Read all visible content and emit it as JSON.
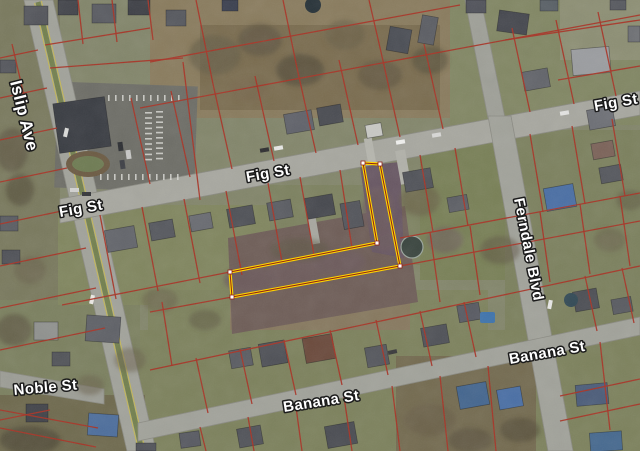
{
  "map": {
    "width": 640,
    "height": 451,
    "base_color": "#83866b",
    "colors": {
      "parcel_line": "#a83325",
      "highlight": "#ffd400",
      "highlight_inner": "#8e2417",
      "vertex": "#ffffff",
      "label_fill": "#ffffff",
      "label_halo": "#1b1b1b",
      "road": "#a5a59d"
    },
    "streets": [
      {
        "id": "islip-ave",
        "name": "Islip Ave",
        "polygon": "24,0 53,0 156,451 127,451",
        "fill": "#a2a39b",
        "median": {
          "line": "38,2 142,451",
          "color": "#73804e",
          "width": 5,
          "edge_color": "#c6b952",
          "edges": [
            "34.6,3 138.6,451",
            "41.4,1 145.4,451"
          ]
        },
        "labels": [
          {
            "text": "Islip Ave",
            "x": 10,
            "y": 82,
            "rotate": 76,
            "size": 17
          }
        ]
      },
      {
        "id": "fig-st",
        "name": "Fig St",
        "polygon": "60,199 640,91 640,115 60,223",
        "fill": "#a8a8a0",
        "labels": [
          {
            "text": "Fig St",
            "x": 60,
            "y": 217,
            "rotate": -10,
            "size": 15
          },
          {
            "text": "Fig St",
            "x": 247,
            "y": 182,
            "rotate": -10,
            "size": 15
          },
          {
            "text": "Fig St",
            "x": 595,
            "y": 111,
            "rotate": -10,
            "size": 15
          }
        ]
      },
      {
        "id": "ferndale-north",
        "name": "",
        "polygon": "465,0 481,0 505,118 488,118",
        "fill": "#9fa098",
        "labels": []
      },
      {
        "id": "ferndale-blvd",
        "name": "Ferndale Blvd",
        "polygon": "488,116 511,116 573,451 548,451",
        "fill": "#a2a39b",
        "labels": [
          {
            "text": "Ferndale Blvd",
            "x": 514,
            "y": 199,
            "rotate": 79,
            "size": 15
          }
        ]
      },
      {
        "id": "banana-st",
        "name": "Banana St",
        "polygon": "138,423 640,317 640,335 138,441",
        "fill": "#a2a39b",
        "labels": [
          {
            "text": "Banana St",
            "x": 284,
            "y": 412,
            "rotate": -9,
            "size": 15
          },
          {
            "text": "Banana St",
            "x": 510,
            "y": 364,
            "rotate": -10,
            "size": 15
          }
        ]
      },
      {
        "id": "noble-st",
        "name": "Noble St",
        "polygon": "0,371 104,389 104,404 0,387",
        "fill": "#9d9e96",
        "labels": [
          {
            "text": "Noble St",
            "x": 14,
            "y": 395,
            "rotate": -5,
            "size": 15
          }
        ]
      }
    ],
    "highlight_parcel": {
      "points": "363,163 380,164 400,266 232,297 230,272 377,243",
      "stroke": "#ffd400",
      "stroke_width": 3.2,
      "under_stroke": "#8e2417",
      "under_width": 1,
      "vertex_fill": "#ffffff",
      "vertex_stroke": "#8e2417",
      "vertex_size": 4,
      "vertices": [
        [
          363,
          163
        ],
        [
          380,
          164
        ],
        [
          400,
          266
        ],
        [
          232,
          297
        ],
        [
          230,
          272
        ],
        [
          377,
          243
        ]
      ]
    },
    "patches": [
      [
        0,
        0,
        60,
        300,
        "#7a7a5e",
        1,
        0
      ],
      [
        0,
        300,
        140,
        151,
        "#7c8160",
        1,
        0
      ],
      [
        150,
        0,
        310,
        118,
        "#8a7c5e",
        1,
        0
      ],
      [
        200,
        25,
        240,
        85,
        "#7b6d50",
        1,
        0
      ],
      [
        450,
        0,
        190,
        125,
        "#828764",
        1,
        0
      ],
      [
        560,
        0,
        80,
        60,
        "#8d8f74",
        1,
        0
      ],
      [
        58,
        205,
        220,
        100,
        "#81865f",
        1,
        0
      ],
      [
        270,
        185,
        150,
        80,
        "#7d8260",
        1,
        0
      ],
      [
        420,
        140,
        220,
        140,
        "#798057",
        1,
        0
      ],
      [
        505,
        130,
        135,
        210,
        "#7c815e",
        1,
        0
      ],
      [
        148,
        290,
        340,
        125,
        "#7e835e",
        1,
        0
      ],
      [
        230,
        296,
        180,
        68,
        "#87795f",
        1,
        0
      ],
      [
        140,
        330,
        500,
        121,
        "#7d825d",
        1,
        0
      ],
      [
        396,
        356,
        140,
        95,
        "#746b50",
        1,
        0
      ],
      [
        0,
        395,
        145,
        56,
        "#6f6a4e",
        1,
        0
      ],
      {
        "points": "228,238 405,206 418,302 232,334",
        "fill": "#6f5e58",
        "opacity": 1
      },
      {
        "points": "360,166 400,162 404,258 372,252",
        "fill": "#685763",
        "opacity": 1
      },
      [
        56,
        84,
        140,
        106,
        "#6e6e67",
        1,
        2
      ]
    ],
    "driveways": [
      [
        398,
        150,
        10,
        34,
        -10,
        "#b2b2aa"
      ],
      [
        366,
        138,
        8,
        26,
        -10,
        "#b6b6ae"
      ],
      [
        310,
        218,
        8,
        26,
        -10,
        "#a8a8a0"
      ]
    ],
    "parcel_lines": {
      "color": "#a83325",
      "width": 1.3,
      "opacity": 0.95,
      "segments": [
        "140,108 640,15",
        "150,62 460,5",
        "50,68 183,58",
        "183,62 200,200",
        "78,0 83,44",
        "112,0 117,42",
        "148,0 153,40",
        "45,45 150,28",
        "150,184 131,98",
        "190,177 171,91",
        "232,169 213,84",
        "274,161 255,76",
        "316,153 297,68",
        "358,145 339,60",
        "400,137 381,52",
        "443,129 424,44",
        "213,84 196,0",
        "297,68 283,0",
        "381,52 369,0",
        "530,112 512,28",
        "574,104 556,20",
        "616,96 598,12",
        "505,40 640,20",
        "558,80 640,66",
        "62,305 230,272",
        "400,238 640,193",
        "150,312 232,297",
        "400,266 640,221",
        "150,370 640,266",
        "100,215 116,299",
        "142,207 158,291",
        "184,199 200,283",
        "226,191 242,275",
        "268,183 282,262",
        "300,177 314,255",
        "340,170 352,248",
        "420,155 433,232",
        "455,148 468,226",
        "530,134 543,212",
        "572,126 585,204",
        "612,119 625,196",
        "196,358 208,413",
        "240,349 252,404",
        "284,340 296,395",
        "330,330 342,385",
        "376,320 388,375",
        "420,311 432,366",
        "464,302 476,357",
        "585,276 597,331",
        "622,268 634,323",
        "430,232 440,302",
        "470,226 480,295",
        "540,212 550,282",
        "580,204 590,274",
        "620,196 630,266",
        "162,302 172,366",
        "200,427 206,451",
        "248,417 254,451",
        "296,407 302,451",
        "344,397 352,451",
        "392,386 400,451",
        "440,376 448,451",
        "488,366 496,451",
        "600,342 610,430",
        "560,396 640,379",
        "560,421 640,404",
        "0,428 96,447",
        "0,58 38,50",
        "0,98 47,88",
        "0,140 57,128",
        "0,182 67,168",
        "0,224 76,208",
        "0,266 86,248",
        "0,308 96,288",
        "0,350 105,328",
        "0,420 50,410",
        "12,44 26,104",
        "0,410 98,428"
      ]
    },
    "houses": [
      [
        24,
        6,
        24,
        19,
        0,
        "#54565c"
      ],
      [
        58,
        0,
        20,
        15,
        0,
        "#44464c"
      ],
      [
        92,
        4,
        24,
        19,
        0,
        "#5a5c62"
      ],
      [
        128,
        0,
        22,
        15,
        0,
        "#3f4147"
      ],
      [
        166,
        10,
        20,
        16,
        0,
        "#56585e"
      ],
      [
        222,
        0,
        16,
        11,
        0,
        "#3c4150"
      ],
      [
        388,
        28,
        22,
        24,
        10,
        "#4b4e55"
      ],
      [
        420,
        16,
        16,
        28,
        10,
        "#5c5e64"
      ],
      [
        466,
        0,
        20,
        13,
        0,
        "#50525a"
      ],
      [
        498,
        12,
        30,
        21,
        8,
        "#45474e"
      ],
      [
        540,
        0,
        18,
        11,
        0,
        "#596066"
      ],
      [
        572,
        48,
        38,
        26,
        -5,
        "#9b9da0"
      ],
      [
        628,
        26,
        12,
        16,
        0,
        "#6f7175"
      ],
      [
        610,
        0,
        16,
        10,
        0,
        "#585a60"
      ],
      [
        285,
        112,
        28,
        20,
        -10,
        "#60626a"
      ],
      [
        318,
        106,
        24,
        18,
        -10,
        "#4a4c52"
      ],
      [
        366,
        124,
        16,
        13,
        -10,
        "#c9c9c5"
      ],
      [
        523,
        70,
        26,
        19,
        -10,
        "#63656b"
      ],
      [
        588,
        108,
        26,
        20,
        -10,
        "#6e7076"
      ],
      [
        592,
        142,
        22,
        16,
        -10,
        "#7b6258"
      ],
      [
        56,
        100,
        52,
        50,
        -8,
        "#3a3d43"
      ],
      [
        106,
        228,
        30,
        22,
        -10,
        "#64666c"
      ],
      [
        150,
        221,
        24,
        18,
        -10,
        "#56585e"
      ],
      [
        190,
        214,
        22,
        16,
        -10,
        "#6a6c72"
      ],
      [
        228,
        207,
        26,
        19,
        -10,
        "#4e5056"
      ],
      [
        268,
        201,
        24,
        18,
        -10,
        "#5b5d63"
      ],
      [
        306,
        196,
        28,
        21,
        -10,
        "#46484e"
      ],
      [
        342,
        202,
        20,
        26,
        -10,
        "#54565c"
      ],
      [
        404,
        170,
        28,
        20,
        -10,
        "#515359"
      ],
      [
        448,
        196,
        20,
        15,
        -10,
        "#5d5f65"
      ],
      [
        545,
        186,
        30,
        23,
        -10,
        "#4a6fa5"
      ],
      [
        600,
        166,
        22,
        16,
        -10,
        "#56585e"
      ],
      [
        0,
        216,
        18,
        15,
        0,
        "#5a5c62"
      ],
      [
        0,
        60,
        16,
        13,
        0,
        "#54565c"
      ],
      [
        2,
        250,
        18,
        14,
        0,
        "#505258"
      ],
      [
        34,
        322,
        24,
        18,
        0,
        "#90928f"
      ],
      [
        86,
        316,
        34,
        26,
        4,
        "#5f6167"
      ],
      [
        26,
        404,
        22,
        18,
        0,
        "#42444a"
      ],
      [
        88,
        414,
        30,
        22,
        4,
        "#4e6f9d"
      ],
      [
        52,
        352,
        18,
        14,
        0,
        "#525459"
      ],
      [
        230,
        349,
        22,
        18,
        -10,
        "#5a5c62"
      ],
      [
        260,
        342,
        26,
        23,
        -10,
        "#4f5157"
      ],
      [
        304,
        336,
        30,
        25,
        -10,
        "#6b4a3c"
      ],
      [
        366,
        346,
        22,
        20,
        -10,
        "#55575d"
      ],
      [
        422,
        326,
        26,
        19,
        -10,
        "#505258"
      ],
      [
        458,
        304,
        22,
        17,
        -10,
        "#575961"
      ],
      [
        574,
        290,
        24,
        20,
        -10,
        "#4d4f55"
      ],
      [
        612,
        298,
        20,
        15,
        -10,
        "#585a60"
      ],
      [
        326,
        424,
        30,
        22,
        -10,
        "#4a4c52"
      ],
      [
        238,
        427,
        24,
        19,
        -10,
        "#515359"
      ],
      [
        180,
        432,
        20,
        15,
        -8,
        "#575961"
      ],
      [
        458,
        384,
        30,
        23,
        -10,
        "#44668f"
      ],
      [
        498,
        388,
        24,
        20,
        -10,
        "#4a6fa5"
      ],
      [
        576,
        384,
        32,
        21,
        -5,
        "#4c5d7a"
      ],
      [
        590,
        432,
        32,
        19,
        -4,
        "#46698f"
      ],
      [
        136,
        443,
        20,
        8,
        0,
        "#505258"
      ]
    ],
    "trees": {
      "fills": [
        "#5b523f",
        "#6a6049",
        "#6e5c5e",
        "#4e4937",
        "#7a6a50"
      ],
      "blobs": [
        [
          215,
          55,
          26,
          20,
          1,
          0.7
        ],
        [
          260,
          40,
          22,
          16,
          0,
          0.6
        ],
        [
          300,
          70,
          24,
          16,
          3,
          0.6
        ],
        [
          345,
          35,
          20,
          15,
          1,
          0.6
        ],
        [
          380,
          75,
          22,
          15,
          0,
          0.55
        ],
        [
          430,
          60,
          18,
          14,
          3,
          0.5
        ],
        [
          250,
          90,
          20,
          12,
          4,
          0.5
        ],
        [
          12,
          150,
          16,
          22,
          0,
          0.6
        ],
        [
          20,
          190,
          14,
          16,
          3,
          0.55
        ],
        [
          30,
          270,
          16,
          14,
          1,
          0.5
        ],
        [
          14,
          330,
          18,
          16,
          0,
          0.6
        ],
        [
          30,
          440,
          30,
          14,
          3,
          0.7
        ],
        [
          90,
          385,
          14,
          10,
          1,
          0.5
        ],
        [
          250,
          280,
          26,
          14,
          2,
          0.75
        ],
        [
          295,
          272,
          28,
          14,
          2,
          0.7
        ],
        [
          340,
          262,
          26,
          13,
          2,
          0.75
        ],
        [
          378,
          210,
          16,
          22,
          2,
          0.7
        ],
        [
          385,
          240,
          14,
          12,
          2,
          0.6
        ],
        [
          300,
          250,
          30,
          12,
          0,
          0.4
        ],
        [
          420,
          200,
          20,
          16,
          1,
          0.6
        ],
        [
          445,
          240,
          18,
          13,
          2,
          0.55
        ],
        [
          500,
          250,
          20,
          14,
          0,
          0.5
        ],
        [
          430,
          420,
          26,
          16,
          1,
          0.65
        ],
        [
          470,
          440,
          22,
          12,
          0,
          0.6
        ],
        [
          520,
          430,
          20,
          12,
          3,
          0.55
        ],
        [
          160,
          300,
          18,
          12,
          1,
          0.5
        ],
        [
          205,
          320,
          16,
          10,
          0,
          0.45
        ],
        [
          610,
          240,
          16,
          12,
          1,
          0.5
        ],
        [
          630,
          200,
          14,
          10,
          0,
          0.45
        ],
        [
          130,
          360,
          16,
          12,
          1,
          0.5
        ]
      ]
    },
    "pools": [
      {
        "type": "circle",
        "cx": 313,
        "cy": 5,
        "r": 8,
        "fill": "#273238"
      },
      {
        "type": "circle",
        "cx": 412,
        "cy": 247,
        "r": 11,
        "fill": "#3a453f",
        "stroke": "#9aa59c"
      },
      {
        "type": "rect",
        "x": 480,
        "y": 312,
        "w": 15,
        "h": 11,
        "fill": "#3f74ad"
      },
      {
        "type": "circle",
        "cx": 571,
        "cy": 300,
        "r": 7,
        "fill": "#334a56"
      }
    ],
    "landscape_island": {
      "cx": 88,
      "cy": 164,
      "rx": 22,
      "ry": 13,
      "ring": "#6b5a42",
      "center": "#6e7b52"
    },
    "parking_stripes": {
      "color": "#d8d8d4",
      "columns": [
        {
          "x": 145,
          "y0": 112,
          "step": 5.2,
          "n": 10,
          "w": 7,
          "h": 1.6
        },
        {
          "x": 156,
          "y0": 111,
          "step": 5.2,
          "n": 10,
          "w": 7,
          "h": 1.6
        }
      ],
      "rows": [
        {
          "y": 95,
          "x0": 108,
          "step": 7,
          "n": 11,
          "w": 1.6,
          "h": 6
        },
        {
          "y": 174,
          "x0": 100,
          "step": 7,
          "n": 12,
          "w": 1.6,
          "h": 6
        }
      ]
    },
    "cars": [
      [
        260,
        148,
        9,
        4,
        -10,
        "#2e2e30"
      ],
      [
        274,
        146,
        9,
        4,
        -10,
        "#e8e8e6"
      ],
      [
        396,
        140,
        9,
        4,
        -10,
        "#f0f0ee"
      ],
      [
        432,
        133,
        9,
        4,
        -10,
        "#d8d8d6"
      ],
      [
        560,
        111,
        9,
        4,
        -10,
        "#e4e4e2"
      ],
      [
        90,
        295,
        4,
        9,
        13,
        "#eceae6"
      ],
      [
        64,
        128,
        4,
        9,
        13,
        "#dcdcda"
      ],
      [
        548,
        300,
        4,
        9,
        11,
        "#e8e8e6"
      ],
      [
        388,
        350,
        9,
        4,
        -12,
        "#3a3a3c"
      ],
      [
        118,
        142,
        5,
        9,
        -8,
        "#2c2e32"
      ],
      [
        126,
        150,
        5,
        9,
        -8,
        "#c8c8c6"
      ],
      [
        120,
        160,
        5,
        9,
        -8,
        "#3e4046"
      ],
      [
        70,
        188,
        9,
        4,
        0,
        "#d2d2d0"
      ],
      [
        82,
        192,
        9,
        4,
        0,
        "#333539"
      ]
    ]
  }
}
